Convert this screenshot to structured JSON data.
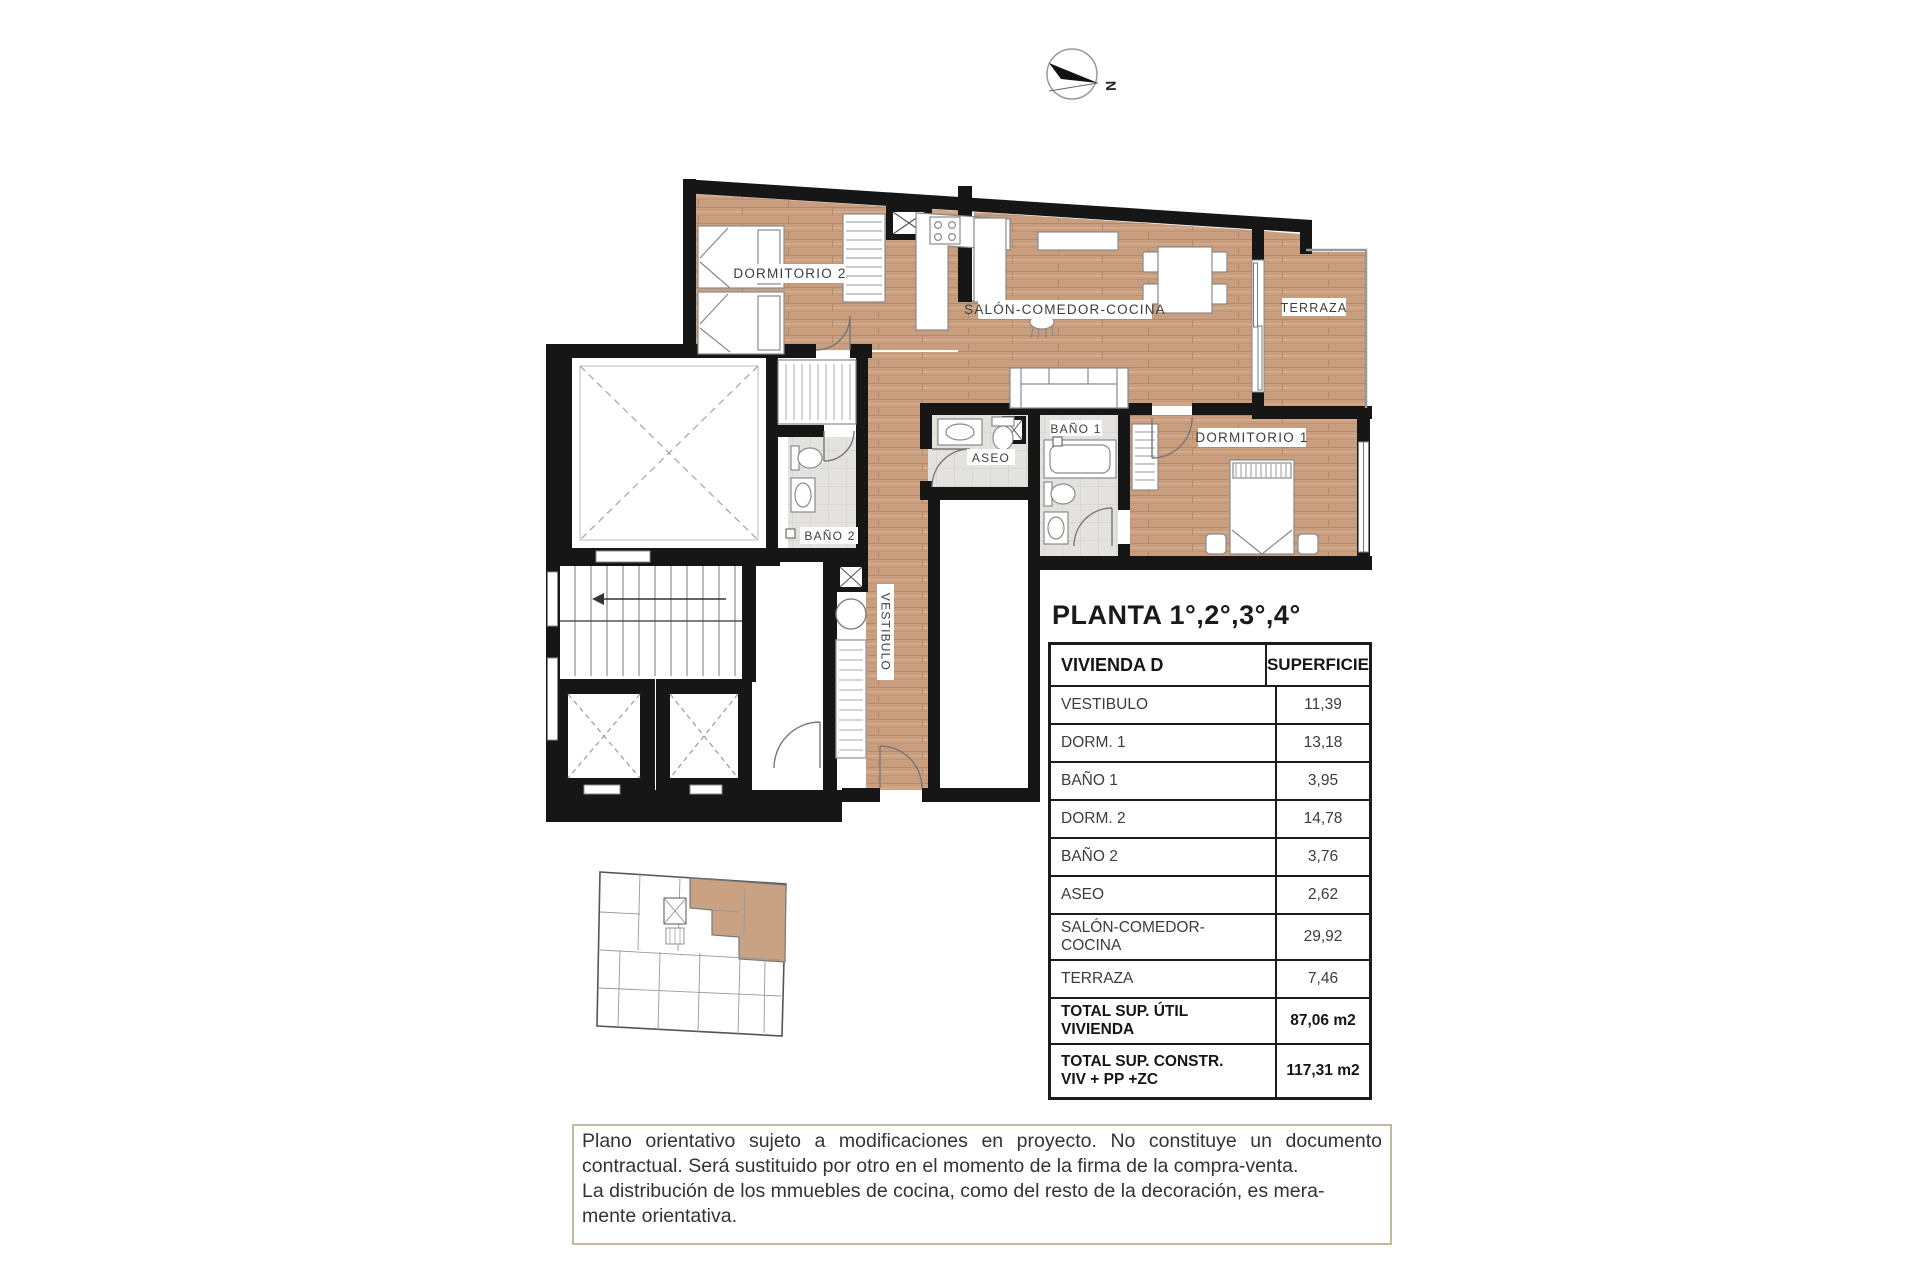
{
  "compass": {
    "label": "N"
  },
  "plan": {
    "labels": {
      "dormitorio2": "DORMITORIO 2",
      "salon": "SALÓN-COMEDOR-COCINA",
      "terraza": "TERRAZA",
      "dormitorio1": "DORMITORIO 1",
      "bano1": "BAÑO 1",
      "bano2": "BAÑO 2",
      "aseo": "ASEO",
      "vestibulo": "VESTIBULO"
    },
    "colors": {
      "wood": "#c89e7e",
      "wall": "#161616",
      "tile": "#e3e2df",
      "unit_highlight": "#c9a183"
    }
  },
  "section": {
    "title": "PLANTA 1°,2°,3°,4°"
  },
  "table": {
    "headers": {
      "name": "VIVIENDA D",
      "area": "SUPERFICIE"
    },
    "rows": [
      {
        "label": "VESTIBULO",
        "value": "11,39"
      },
      {
        "label": "DORM. 1",
        "value": "13,18"
      },
      {
        "label": "BAÑO 1",
        "value": "3,95"
      },
      {
        "label": "DORM. 2",
        "value": "14,78"
      },
      {
        "label": "BAÑO 2",
        "value": "3,76"
      },
      {
        "label": "ASEO",
        "value": "2,62"
      },
      {
        "label": "SALÓN-COMEDOR-COCINA",
        "value": "29,92"
      },
      {
        "label": "TERRAZA",
        "value": "7,46"
      }
    ],
    "total_util": {
      "label": "TOTAL SUP. ÚTIL VIVIENDA",
      "value": "87,06 m2"
    },
    "total_constr": {
      "label_line1": "TOTAL SUP. CONSTR.",
      "label_line2": "VIV + PP +ZC",
      "value": "117,31 m2"
    }
  },
  "disclaimer": {
    "lines": [
      "Plano orientativo sujeto a modificaciones en proyecto. No constituye un documento",
      "contractual. Será sustituido por otro en el momento de la firma de la compra-venta.",
      "La distribución de los mmuebles de cocina, como del resto de la decoración, es mera-",
      "mente orientativa."
    ]
  }
}
